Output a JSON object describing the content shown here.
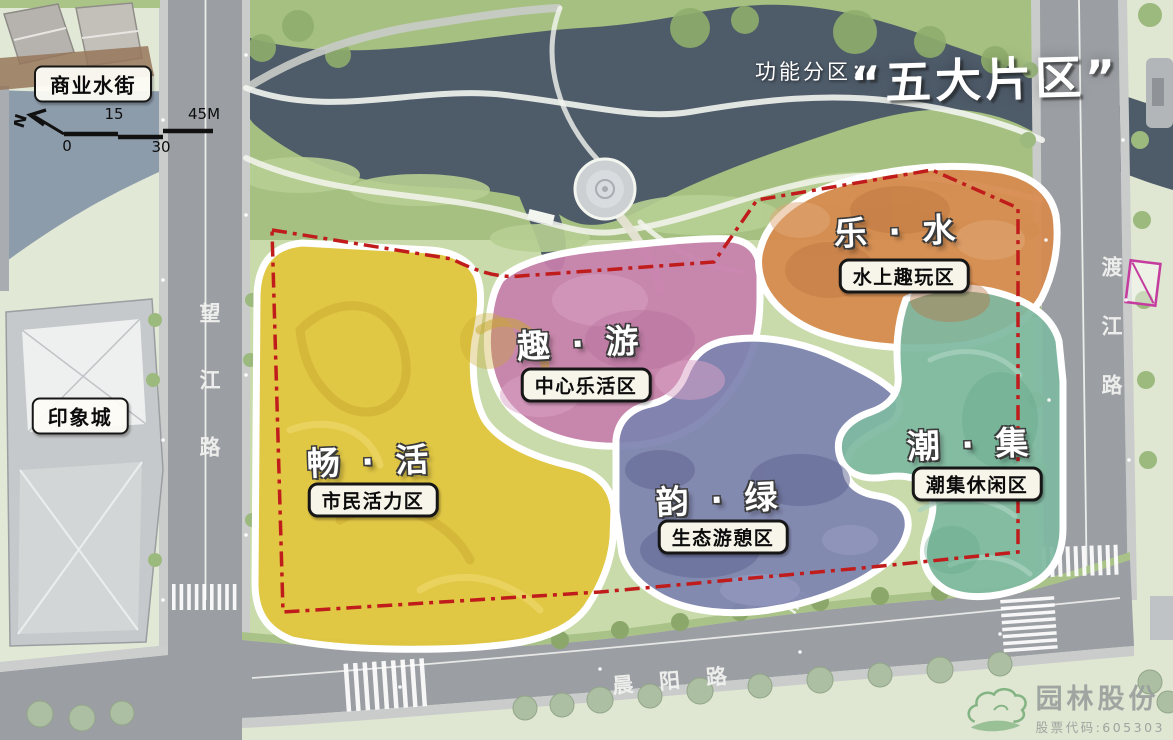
{
  "page": {
    "title_prefix": "功能分区：",
    "title_main": "“五大片区”"
  },
  "landmarks": {
    "commercial_street": "商业水街",
    "impression_city": "印象城"
  },
  "roads": {
    "west": "望江路",
    "east": "渡江路",
    "south": "晨阳路"
  },
  "scale_bar": {
    "north": "N",
    "ticks": [
      "0",
      "15",
      "30",
      "45M"
    ]
  },
  "zones": [
    {
      "name": "chang-huo",
      "title": "畅 · 活",
      "label": "市民活力区",
      "color": "#e2c53c"
    },
    {
      "name": "qu-you",
      "title": "趣 · 游",
      "label": "中心乐活区",
      "color": "#c77fab"
    },
    {
      "name": "le-shui",
      "title": "乐 · 水",
      "label": "水上趣玩区",
      "color": "#d78a4d"
    },
    {
      "name": "yun-lv",
      "title": "韵 · 绿",
      "label": "生态游憩区",
      "color": "#7e83b0"
    },
    {
      "name": "chao-ji",
      "title": "潮 · 集",
      "label": "潮集休闲区",
      "color": "#7fb9a1"
    }
  ],
  "site": {
    "boundary_color": "#c01c1c",
    "marker_color": "#c33c9e"
  },
  "logo": {
    "company": "园林股份",
    "stock_code": "股票代码:605303",
    "icon_color": "#7cb07c"
  }
}
